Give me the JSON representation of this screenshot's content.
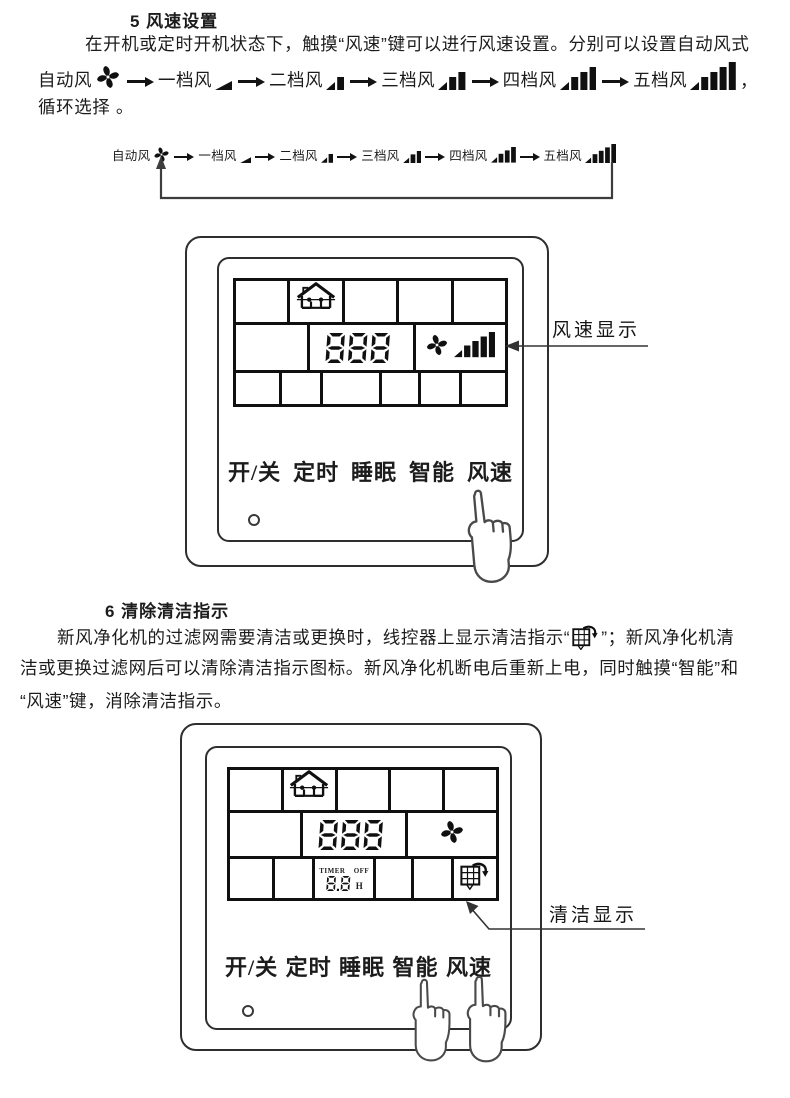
{
  "colors": {
    "ink": "#1c1c1c",
    "lcd_line": "#101010",
    "panel_line": "#2e2e2e"
  },
  "section5": {
    "heading": "5 风速设置",
    "para_line1": "在开机或定时开机状态下，触摸“风速”键可以进行风速设置。分别可以设置自动风式",
    "para_tail": "循环选择 。",
    "flow_comma": "，"
  },
  "flow": {
    "items": [
      {
        "label": "自动风",
        "icon": "fan-icon",
        "level": 0
      },
      {
        "label": "一档风",
        "icon": "speed-bars-icon",
        "level": 1
      },
      {
        "label": "二档风",
        "icon": "speed-bars-icon",
        "level": 2
      },
      {
        "label": "三档风",
        "icon": "speed-bars-icon",
        "level": 3
      },
      {
        "label": "四档风",
        "icon": "speed-bars-icon",
        "level": 4
      },
      {
        "label": "五档风",
        "icon": "speed-bars-icon",
        "level": 5
      }
    ]
  },
  "panel1": {
    "lcd": {
      "digits": "888",
      "fan_speed_level": 5
    },
    "buttons": [
      "开/关",
      "定时",
      "睡眠",
      "智能",
      "风速"
    ],
    "callout": "风速显示"
  },
  "section6": {
    "heading": "6 清除清洁指示",
    "para_line1_pre": "新风净化机的过滤网需要清洁或更换时，线控器上显示清洁指示“",
    "para_line1_post": "”；新风净化机清",
    "para_line2": "洁或更换过滤网后可以清除清洁指示图标。新风净化机断电后重新上电，同时触摸“智能”和",
    "para_line3": "“风速”键，消除清洁指示。"
  },
  "panel2": {
    "lcd": {
      "digits": "888",
      "timer_label": "TIMER",
      "timer_off": "OFF",
      "timer_value": "8.8",
      "timer_unit": "H"
    },
    "buttons": [
      "开/关",
      "定时",
      "睡眠",
      "智能",
      "风速"
    ],
    "callout": "清洁显示"
  }
}
